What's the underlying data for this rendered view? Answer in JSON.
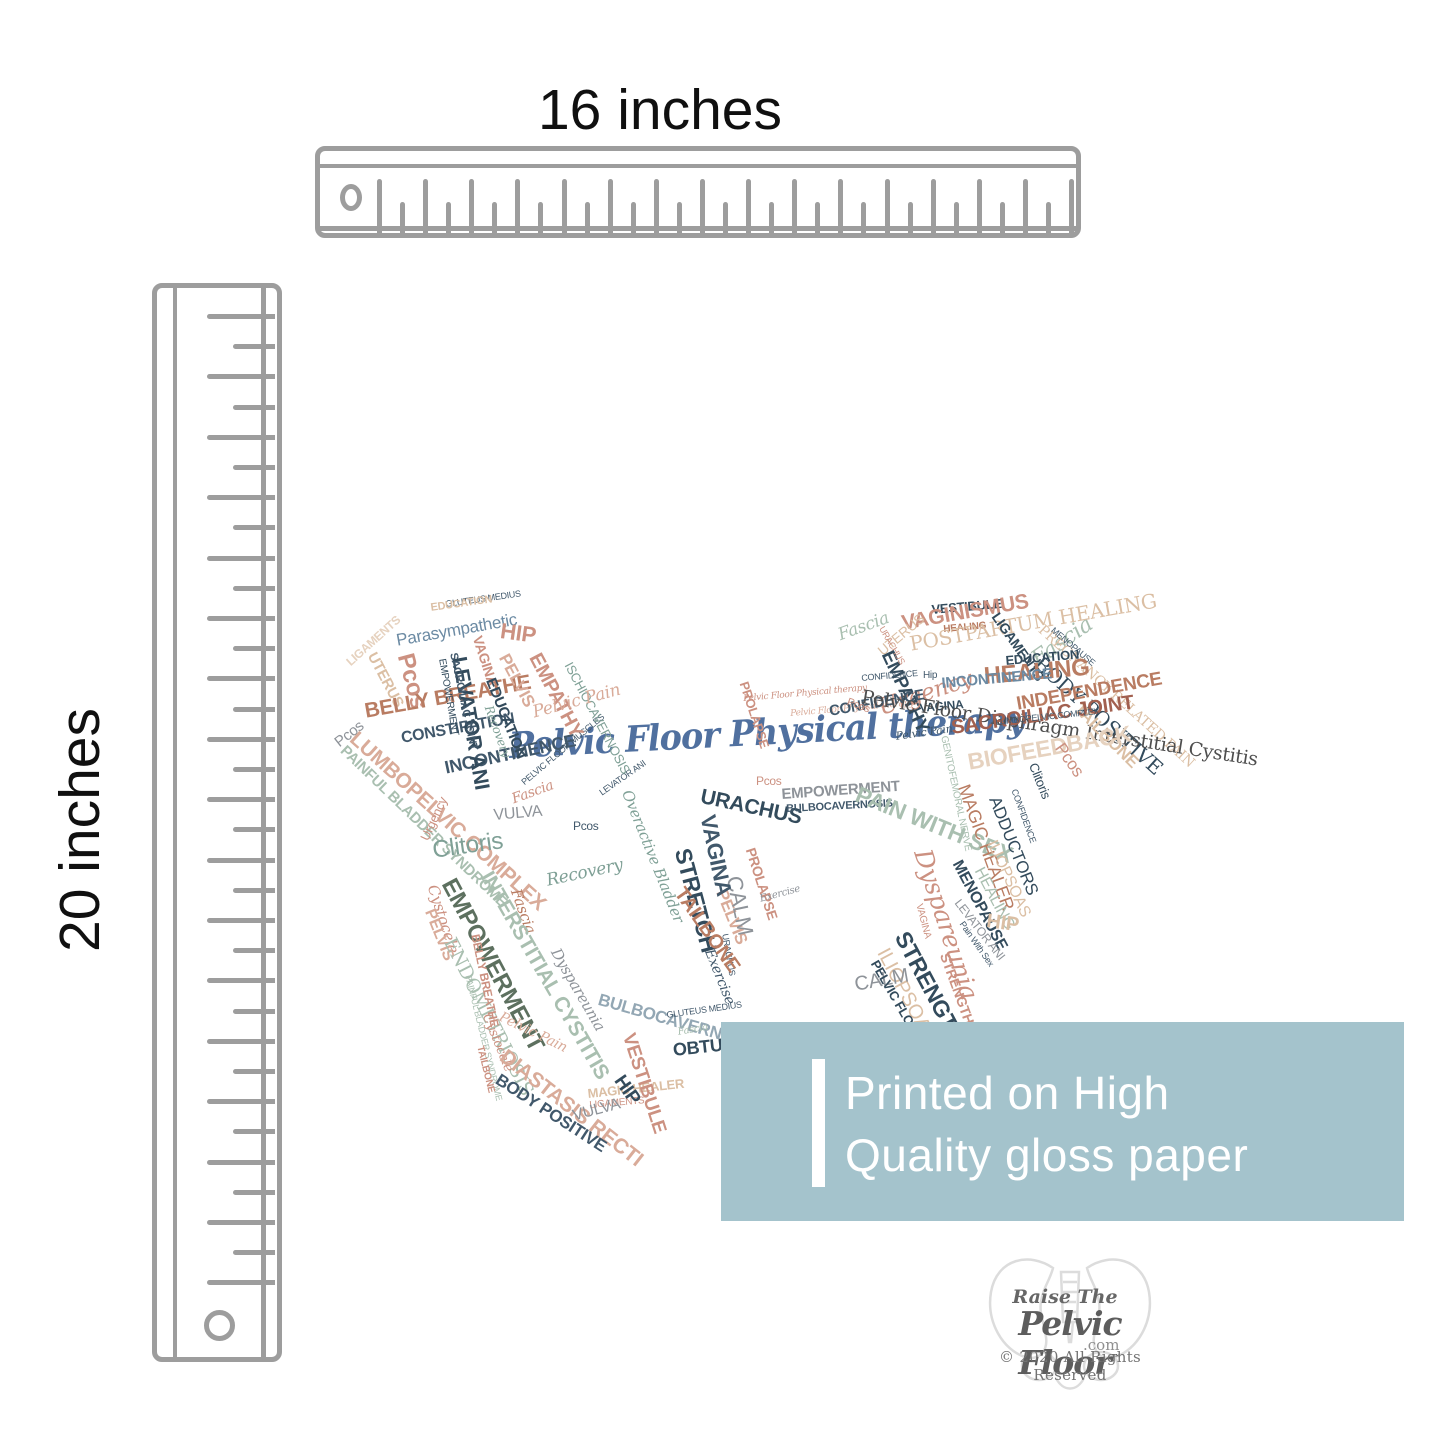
{
  "page": {
    "background": "#ffffff"
  },
  "rulers": {
    "color": "#9d9d9d",
    "horizontal_label": "16 inches",
    "vertical_label": "20 inches"
  },
  "banner": {
    "background": "#a4c3cc",
    "text_color": "#ffffff",
    "line1": "Printed on High",
    "line2": "Quality gloss paper"
  },
  "logo": {
    "line1": "Raise The",
    "line2": "Pelvic Floor",
    "trademark": "™",
    "domain": ".com",
    "copyright": "© 2020 All Rights Reserved"
  },
  "wordcloud": {
    "center_phrase": "Pelvic Floor Physical therapy",
    "center_color": "#50709f",
    "palette": {
      "navy": "#41586b",
      "darknavy": "#334b5c",
      "steel": "#6b8aa3",
      "teal": "#7fa096",
      "sage": "#a9bfb0",
      "olive": "#5d705f",
      "terracotta": "#b97c62",
      "salmon": "#cc9181",
      "lightsalmon": "#d9ab99",
      "tan": "#dbbfa4",
      "beige": "#e6d2bf",
      "gray": "#8e9399",
      "grayblue": "#93a7b4",
      "brick": "#a2604f",
      "charcoal": "#4e4e4e"
    },
    "words": [
      {
        "t": "GLUTEUS MEDIUS",
        "x": 115,
        "y": 25,
        "r": -8,
        "s": 9,
        "c": "navy"
      },
      {
        "t": "EDUCATION",
        "x": 100,
        "y": 28,
        "r": -8,
        "s": 11,
        "c": "tan",
        "f": "b"
      },
      {
        "t": "Parasympathetic",
        "x": 65,
        "y": 57,
        "r": -10,
        "s": 17,
        "c": "steel"
      },
      {
        "t": "UTERUS",
        "x": 48,
        "y": 75,
        "r": 62,
        "s": 15,
        "c": "tan",
        "f": "b"
      },
      {
        "t": "Pcos",
        "x": 86,
        "y": 76,
        "r": 75,
        "s": 24,
        "c": "salmon",
        "f": "b"
      },
      {
        "t": "LIGAMENTS",
        "x": 14,
        "y": 84,
        "r": -42,
        "s": 12,
        "c": "beige",
        "f": "b"
      },
      {
        "t": "Pcos",
        "x": 2,
        "y": 163,
        "r": -38,
        "s": 15,
        "c": "gray"
      },
      {
        "t": "BELLY BREATHE",
        "x": 33,
        "y": 126,
        "r": -10,
        "s": 21,
        "c": "terracotta",
        "f": "b"
      },
      {
        "t": "CONSTIPATION",
        "x": 70,
        "y": 156,
        "r": -10,
        "s": 16,
        "c": "navy",
        "f": "b"
      },
      {
        "t": "LUMBOPELVIC COMPLEX",
        "x": 30,
        "y": 153,
        "r": 42,
        "s": 21,
        "c": "lightsalmon",
        "f": "b"
      },
      {
        "t": "PAINFUL BLADDER SYNDROME",
        "x": 18,
        "y": 168,
        "r": 44,
        "s": 15,
        "c": "sage",
        "f": "b"
      },
      {
        "t": "INCONTINENCE",
        "x": 113,
        "y": 184,
        "r": -12,
        "s": 18,
        "c": "navy",
        "f": "b"
      },
      {
        "t": "Urgency",
        "x": 88,
        "y": 262,
        "r": -65,
        "s": 13,
        "c": "salmon"
      },
      {
        "t": "VULVA",
        "x": 163,
        "y": 233,
        "r": -5,
        "s": 16,
        "c": "gray"
      },
      {
        "t": "Fascia",
        "x": 180,
        "y": 218,
        "r": -20,
        "s": 14,
        "c": "salmon",
        "f": "i"
      },
      {
        "t": "Recovery",
        "x": 215,
        "y": 298,
        "r": -12,
        "s": 17,
        "c": "teal",
        "f": "i"
      },
      {
        "t": "Fascia",
        "x": 192,
        "y": 312,
        "r": 70,
        "s": 15,
        "c": "terracotta",
        "f": "i"
      },
      {
        "t": "Clitoris",
        "x": 101,
        "y": 264,
        "r": -8,
        "s": 24,
        "c": "teal"
      },
      {
        "t": "EMPOWERMENT",
        "x": 128,
        "y": 300,
        "r": 62,
        "s": 24,
        "c": "olive",
        "f": "b"
      },
      {
        "t": "INTERSTITIAL CYSTITIS",
        "x": 165,
        "y": 293,
        "r": 60,
        "s": 21,
        "c": "sage",
        "f": "b"
      },
      {
        "t": "Cystocele",
        "x": 109,
        "y": 308,
        "r": 72,
        "s": 15,
        "c": "salmon",
        "f": "i"
      },
      {
        "t": "PELVIS",
        "x": 106,
        "y": 332,
        "r": 68,
        "s": 16,
        "c": "lightsalmon",
        "f": "b"
      },
      {
        "t": "ENDOMETRIOSIS",
        "x": 127,
        "y": 360,
        "r": 63,
        "s": 19,
        "c": "sage",
        "f": "sr"
      },
      {
        "t": "BELLY BREATHE",
        "x": 151,
        "y": 358,
        "r": 78,
        "s": 12,
        "c": "salmon",
        "f": "b"
      },
      {
        "t": "PAINFUL BLADDER SYNDROME",
        "x": 142,
        "y": 399,
        "r": 76,
        "s": 9,
        "c": "sage"
      },
      {
        "t": "Dyspareunia",
        "x": 231,
        "y": 371,
        "r": 60,
        "s": 15,
        "c": "gray",
        "f": "i"
      },
      {
        "t": "Pelvic Pain",
        "x": 173,
        "y": 435,
        "r": 26,
        "s": 14,
        "c": "lightsalmon",
        "f": "i"
      },
      {
        "t": "Cystocele",
        "x": 162,
        "y": 437,
        "r": 68,
        "s": 13,
        "c": "salmon",
        "f": "i"
      },
      {
        "t": "TAILBONE",
        "x": 154,
        "y": 470,
        "r": 76,
        "s": 10,
        "c": "salmon",
        "f": "b"
      },
      {
        "t": "DIASTASIS RECTI",
        "x": 179,
        "y": 471,
        "r": 38,
        "s": 21,
        "c": "lightsalmon",
        "f": "b"
      },
      {
        "t": "BODY POSITIVE",
        "x": 172,
        "y": 496,
        "r": 33,
        "s": 17,
        "c": "navy",
        "f": "b"
      },
      {
        "t": "MAGIC HEALER",
        "x": 257,
        "y": 512,
        "r": -6,
        "s": 13,
        "c": "tan",
        "f": "b"
      },
      {
        "t": "LIGAMENTS",
        "x": 259,
        "y": 526,
        "r": -5,
        "s": 10,
        "c": "salmon"
      },
      {
        "t": "VULVA",
        "x": 241,
        "y": 534,
        "r": -15,
        "s": 16,
        "c": "gray"
      },
      {
        "t": "HIP",
        "x": 296,
        "y": 497,
        "r": 55,
        "s": 19,
        "c": "darknavy",
        "f": "b"
      },
      {
        "t": "VESTIBULE",
        "x": 307,
        "y": 456,
        "r": 72,
        "s": 19,
        "c": "salmon",
        "f": "b"
      },
      {
        "t": "OBTURATOR",
        "x": 342,
        "y": 466,
        "r": -6,
        "s": 18,
        "c": "darknavy",
        "f": "b"
      },
      {
        "t": "BULBOCAVERNOSIS",
        "x": 271,
        "y": 416,
        "r": 16,
        "s": 17,
        "c": "grayblue",
        "f": "b"
      },
      {
        "t": "GLUTEUS MEDIUS",
        "x": 336,
        "y": 436,
        "r": -8,
        "s": 9,
        "c": "navy"
      },
      {
        "t": "Fascia",
        "x": 347,
        "y": 453,
        "r": -10,
        "s": 10,
        "c": "sage",
        "f": "i"
      },
      {
        "t": "Exercise",
        "x": 385,
        "y": 372,
        "r": 68,
        "s": 14,
        "c": "navy",
        "f": "i"
      },
      {
        "t": "URACHUS",
        "x": 399,
        "y": 358,
        "r": 80,
        "s": 9,
        "c": "navy"
      },
      {
        "t": "STRETCH",
        "x": 363,
        "y": 271,
        "r": 75,
        "s": 23,
        "c": "darknavy",
        "f": "b"
      },
      {
        "t": "TAILBONE",
        "x": 357,
        "y": 309,
        "r": 55,
        "s": 20,
        "c": "terracotta",
        "f": "b"
      },
      {
        "t": "PELVIS",
        "x": 399,
        "y": 312,
        "r": 68,
        "s": 17,
        "c": "lightsalmon",
        "f": "b"
      },
      {
        "t": "CALM",
        "x": 414,
        "y": 299,
        "r": 78,
        "s": 22,
        "c": "gray"
      },
      {
        "t": "PROLAPSE",
        "x": 427,
        "y": 271,
        "r": 72,
        "s": 14,
        "c": "salmon",
        "f": "b"
      },
      {
        "t": "Exercise",
        "x": 429,
        "y": 320,
        "r": -15,
        "s": 10,
        "c": "gray",
        "f": "i"
      },
      {
        "t": "VAGINA",
        "x": 388,
        "y": 238,
        "r": 78,
        "s": 22,
        "c": "navy",
        "f": "b"
      },
      {
        "t": "URACHUS",
        "x": 373,
        "y": 211,
        "r": 12,
        "s": 21,
        "c": "darknavy",
        "f": "b"
      },
      {
        "t": "Overactive Bladder",
        "x": 303,
        "y": 213,
        "r": 68,
        "s": 15,
        "c": "teal",
        "f": "i"
      },
      {
        "t": "Pelvic Floor Physical therapy",
        "x": 413,
        "y": 120,
        "r": -5,
        "s": 9,
        "c": "salmon",
        "f": "s"
      },
      {
        "t": "Pelvic Floor Physical therapy",
        "x": 460,
        "y": 135,
        "r": -5,
        "s": 9,
        "c": "lightsalmon",
        "f": "s"
      },
      {
        "t": "Pcos",
        "x": 426,
        "y": 200,
        "r": 0,
        "s": 12,
        "c": "salmon"
      },
      {
        "t": "EMPOWERMENT",
        "x": 451,
        "y": 212,
        "r": -4,
        "s": 15,
        "c": "gray",
        "f": "b"
      },
      {
        "t": "BULBOCAVERNOSIS",
        "x": 456,
        "y": 229,
        "r": -3,
        "s": 11,
        "c": "navy",
        "f": "b"
      },
      {
        "t": "PROLAPSE",
        "x": 420,
        "y": 105,
        "r": 72,
        "s": 13,
        "c": "salmon",
        "f": "b"
      },
      {
        "t": "PELVIC FLOOR MUSCLES",
        "x": 190,
        "y": 205,
        "r": -40,
        "s": 9,
        "c": "navy"
      },
      {
        "t": "LEVATOR ANI",
        "x": 268,
        "y": 215,
        "r": -35,
        "s": 9,
        "c": "navy"
      },
      {
        "t": "Pcos",
        "x": 243,
        "y": 245,
        "r": 0,
        "s": 12,
        "c": "navy"
      },
      {
        "t": "Fascia",
        "x": 506,
        "y": 53,
        "r": -20,
        "s": 17,
        "c": "sage",
        "f": "i"
      },
      {
        "t": "HEALING",
        "x": 613,
        "y": 50,
        "r": -5,
        "s": 10,
        "c": "terracotta",
        "f": "b"
      },
      {
        "t": "EMPATHY",
        "x": 565,
        "y": 73,
        "r": 65,
        "s": 19,
        "c": "darknavy",
        "f": "b"
      },
      {
        "t": "Fascia",
        "x": 698,
        "y": 78,
        "r": -35,
        "s": 22,
        "c": "sage",
        "f": "i"
      },
      {
        "t": "CONFIDENCE",
        "x": 531,
        "y": 99,
        "r": -5,
        "s": 9,
        "c": "navy"
      },
      {
        "t": "Urgency",
        "x": 546,
        "y": 123,
        "r": -18,
        "s": 23,
        "c": "salmon",
        "f": "i"
      },
      {
        "t": "Pelvic Pain",
        "x": 565,
        "y": 156,
        "r": -8,
        "s": 11,
        "c": "navy",
        "f": "i"
      },
      {
        "t": "VAGINA",
        "x": 589,
        "y": 127,
        "r": -5,
        "s": 12,
        "c": "darknavy",
        "f": "b"
      },
      {
        "t": "CONFIDENCE",
        "x": 498,
        "y": 129,
        "r": -10,
        "s": 15,
        "c": "navy",
        "f": "b"
      },
      {
        "t": "Pcos",
        "x": 519,
        "y": 122,
        "r": 20,
        "s": 11,
        "c": "salmon"
      },
      {
        "t": "HIP",
        "x": 172,
        "y": 45,
        "r": 8,
        "s": 22,
        "c": "salmon",
        "f": "b"
      },
      {
        "t": "VAGINA",
        "x": 154,
        "y": 59,
        "r": 72,
        "s": 14,
        "c": "salmon",
        "f": "b"
      },
      {
        "t": "PELVIS",
        "x": 181,
        "y": 76,
        "r": 62,
        "s": 17,
        "c": "lightsalmon",
        "f": "b"
      },
      {
        "t": "EMPATHY",
        "x": 213,
        "y": 75,
        "r": 62,
        "s": 20,
        "c": "salmon",
        "f": "b"
      },
      {
        "t": "ISCHIOCAVERNOSIS",
        "x": 244,
        "y": 85,
        "r": 62,
        "s": 13,
        "c": "teal"
      },
      {
        "t": "EDUCATION",
        "x": 167,
        "y": 101,
        "r": 68,
        "s": 15,
        "c": "darknavy",
        "f": "b"
      },
      {
        "t": "LEVATOR ANI",
        "x": 139,
        "y": 80,
        "r": 80,
        "s": 21,
        "c": "darknavy",
        "f": "b"
      },
      {
        "t": "SACROILIAC JOINT",
        "x": 128,
        "y": 77,
        "r": 78,
        "s": 11,
        "c": "navy",
        "f": "b"
      },
      {
        "t": "EMPOWERMENT",
        "x": 116,
        "y": 83,
        "r": 80,
        "s": 10,
        "c": "darknavy"
      },
      {
        "t": "Recovery",
        "x": 164,
        "y": 129,
        "r": 70,
        "s": 12,
        "c": "teal",
        "f": "i"
      },
      {
        "t": "Pelvic Pain",
        "x": 201,
        "y": 130,
        "r": -15,
        "s": 17,
        "c": "lightsalmon",
        "f": "i"
      },
      {
        "t": "VESTIBULE",
        "x": 601,
        "y": 28,
        "r": -5,
        "s": 13,
        "c": "darknavy",
        "f": "b"
      },
      {
        "t": "VAGINISMUS",
        "x": 570,
        "y": 38,
        "r": -10,
        "s": 21,
        "c": "salmon",
        "f": "b"
      },
      {
        "t": "POSTPARTUM HEALING",
        "x": 578,
        "y": 59,
        "r": -10,
        "s": 20,
        "c": "tan",
        "f": "sr"
      },
      {
        "t": "UTERUS",
        "x": 545,
        "y": 72,
        "r": -40,
        "s": 14,
        "c": "tan"
      },
      {
        "t": "URACHUS",
        "x": 555,
        "y": 50,
        "r": 60,
        "s": 9,
        "c": "salmon"
      },
      {
        "t": "LIGAMENTS",
        "x": 671,
        "y": 35,
        "r": 55,
        "s": 14,
        "c": "darknavy",
        "f": "b"
      },
      {
        "t": "PREGNANCY RELATED PAIN",
        "x": 715,
        "y": 48,
        "r": 42,
        "s": 14,
        "c": "tan",
        "f": "sr"
      },
      {
        "t": "MENOPAUSE",
        "x": 725,
        "y": 51,
        "r": 40,
        "s": 9,
        "c": "navy"
      },
      {
        "t": "BODY POSITIVE",
        "x": 714,
        "y": 78,
        "r": 42,
        "s": 20,
        "c": "darknavy",
        "f": "sr"
      },
      {
        "t": "EDUCATION",
        "x": 675,
        "y": 79,
        "r": -5,
        "s": 13,
        "c": "darknavy",
        "f": "b"
      },
      {
        "t": "HEALING",
        "x": 653,
        "y": 90,
        "r": -5,
        "s": 24,
        "c": "terracotta",
        "f": "b"
      },
      {
        "t": "INCONTINENCE",
        "x": 611,
        "y": 101,
        "r": -5,
        "s": 15,
        "c": "steel",
        "f": "b"
      },
      {
        "t": "Hip",
        "x": 593,
        "y": 96,
        "r": 0,
        "s": 10,
        "c": "navy"
      },
      {
        "t": "Pelvic Floor Diaphragm Interstitial Cystitis",
        "x": 533,
        "y": 113,
        "r": 9,
        "s": 19,
        "c": "charcoal",
        "f": "sr"
      },
      {
        "t": "INDEPENDENCE",
        "x": 685,
        "y": 120,
        "r": -10,
        "s": 19,
        "c": "terracotta",
        "f": "b"
      },
      {
        "t": "TAILBONE",
        "x": 753,
        "y": 125,
        "r": 45,
        "s": 17,
        "c": "tan",
        "f": "b"
      },
      {
        "t": "SACROILIAC JOINT",
        "x": 620,
        "y": 143,
        "r": -8,
        "s": 20,
        "c": "brick",
        "f": "b"
      },
      {
        "t": "LUMBOPELVIC COMPLEX",
        "x": 665,
        "y": 143,
        "r": -6,
        "s": 9,
        "c": "navy"
      },
      {
        "t": "BIOFEEDBACK",
        "x": 636,
        "y": 176,
        "r": -10,
        "s": 23,
        "c": "beige",
        "f": "b"
      },
      {
        "t": "Pcos",
        "x": 736,
        "y": 165,
        "r": 55,
        "s": 17,
        "c": "salmon"
      },
      {
        "t": "Clitoris",
        "x": 709,
        "y": 186,
        "r": 68,
        "s": 13,
        "c": "darknavy"
      },
      {
        "t": "GENITOFEMORAL NERVE",
        "x": 618,
        "y": 160,
        "r": 78,
        "s": 10,
        "c": "sage"
      },
      {
        "t": "PAIN WITH SEX",
        "x": 531,
        "y": 208,
        "r": 22,
        "s": 23,
        "c": "sage",
        "f": "b"
      },
      {
        "t": "MAGIC HEALER",
        "x": 642,
        "y": 207,
        "r": 70,
        "s": 18,
        "c": "terracotta"
      },
      {
        "t": "ADDUCTORS",
        "x": 672,
        "y": 219,
        "r": 68,
        "s": 17,
        "c": "darknavy"
      },
      {
        "t": "CONFIDENCE",
        "x": 688,
        "y": 213,
        "r": 70,
        "s": 9,
        "c": "navy"
      },
      {
        "t": "ILIOPSOAS",
        "x": 668,
        "y": 263,
        "r": 65,
        "s": 16,
        "c": "tan"
      },
      {
        "t": "HEALING",
        "x": 655,
        "y": 290,
        "r": 62,
        "s": 16,
        "c": "sage"
      },
      {
        "t": "Dyspareunia",
        "x": 604,
        "y": 271,
        "r": 72,
        "s": 25,
        "c": "salmon",
        "f": "i"
      },
      {
        "t": "MENOPAUSE",
        "x": 633,
        "y": 283,
        "r": 62,
        "s": 16,
        "c": "darknavy",
        "f": "b"
      },
      {
        "t": "LEVATOR ANI",
        "x": 632,
        "y": 322,
        "r": 52,
        "s": 12,
        "c": "gray"
      },
      {
        "t": "HIP",
        "x": 658,
        "y": 336,
        "r": 8,
        "s": 20,
        "c": "tan",
        "f": "b"
      },
      {
        "t": "Pain With Sex",
        "x": 635,
        "y": 345,
        "r": 55,
        "s": 9,
        "c": "navy"
      },
      {
        "t": "VAGINA",
        "x": 593,
        "y": 328,
        "r": 75,
        "s": 10,
        "c": "salmon"
      },
      {
        "t": "STRENGTH",
        "x": 581,
        "y": 353,
        "r": 62,
        "s": 23,
        "c": "darknavy",
        "f": "b"
      },
      {
        "t": "ILIOPSOAS",
        "x": 561,
        "y": 370,
        "r": 62,
        "s": 20,
        "c": "tan"
      },
      {
        "t": "STRENGTH",
        "x": 621,
        "y": 376,
        "r": 70,
        "s": 14,
        "c": "salmon",
        "f": "b"
      },
      {
        "t": "CALM",
        "x": 523,
        "y": 400,
        "r": -10,
        "s": 20,
        "c": "gray"
      },
      {
        "t": "PELVIC FLOOR MUSCLES",
        "x": 550,
        "y": 383,
        "r": 60,
        "s": 13,
        "c": "darknavy",
        "f": "b"
      }
    ]
  }
}
